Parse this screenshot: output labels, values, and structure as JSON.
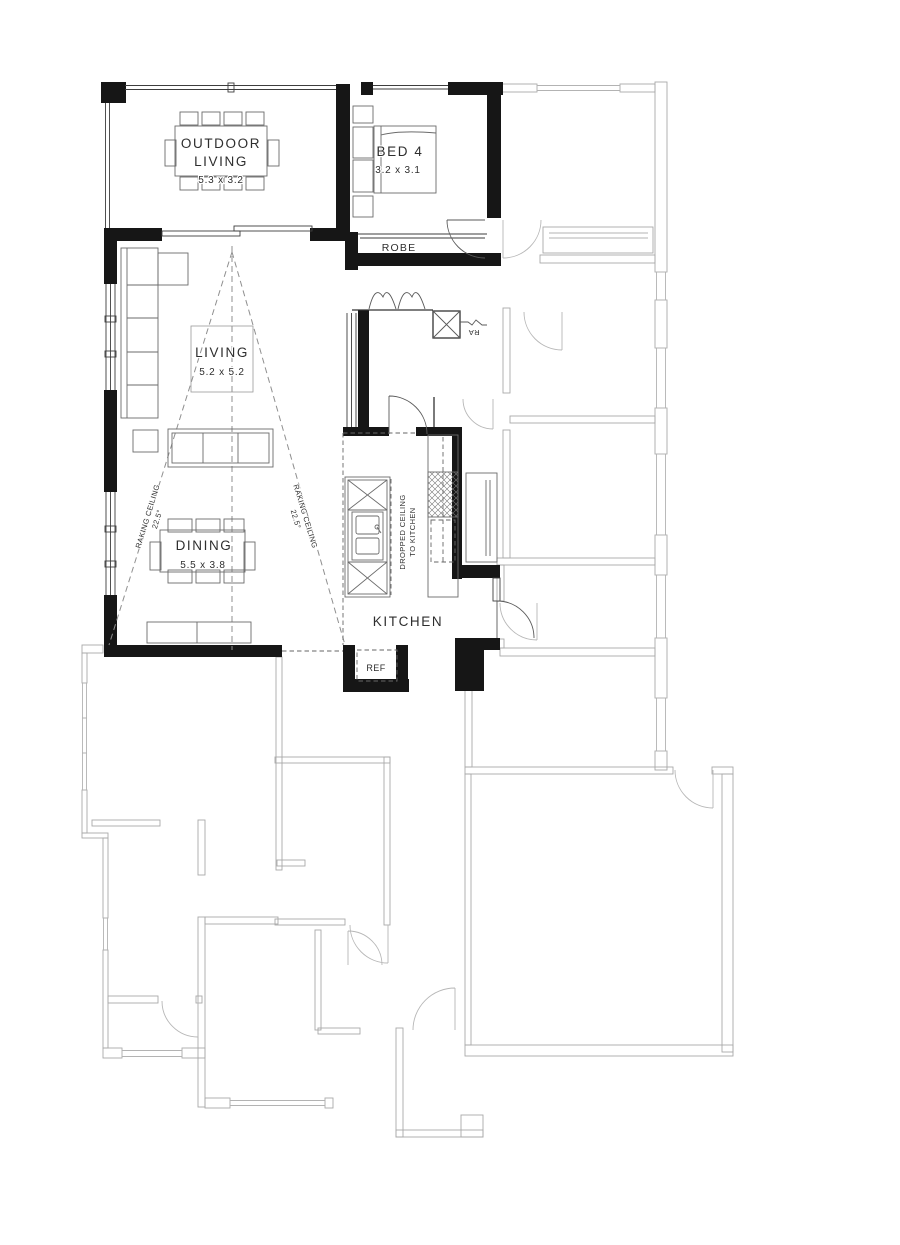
{
  "plan": {
    "colors": {
      "wall": "#161616",
      "ghost_wall": "#a9a9a9",
      "text": "#2e2e2e",
      "dashed_line": "#8f8f8f",
      "background": "#ffffff"
    },
    "rooms": {
      "outdoor_living": {
        "label_line1": "OUTDOOR",
        "label_line2": "LIVING",
        "dims": "5.3 x 3.2"
      },
      "bed4": {
        "label": "BED 4",
        "dims": "3.2 x 3.1"
      },
      "robe": {
        "label": "ROBE"
      },
      "living": {
        "label": "LIVING",
        "dims": "5.2 x 5.2"
      },
      "dining": {
        "label": "DINING",
        "dims": "5.5 x 3.8"
      },
      "kitchen": {
        "label": "KITCHEN"
      },
      "fridge": {
        "label": "REF"
      },
      "return_air": {
        "label": "RA"
      }
    },
    "annotations": {
      "raking_ceiling_left": {
        "line1": "RAKING CEILING",
        "line2": "22.5°"
      },
      "raking_ceiling_right": {
        "line1": "RAKING CEILING",
        "line2": "22.5°"
      },
      "dropped_ceiling": {
        "line1": "DROPPED CEILING",
        "line2": "TO KITCHEN"
      }
    }
  }
}
